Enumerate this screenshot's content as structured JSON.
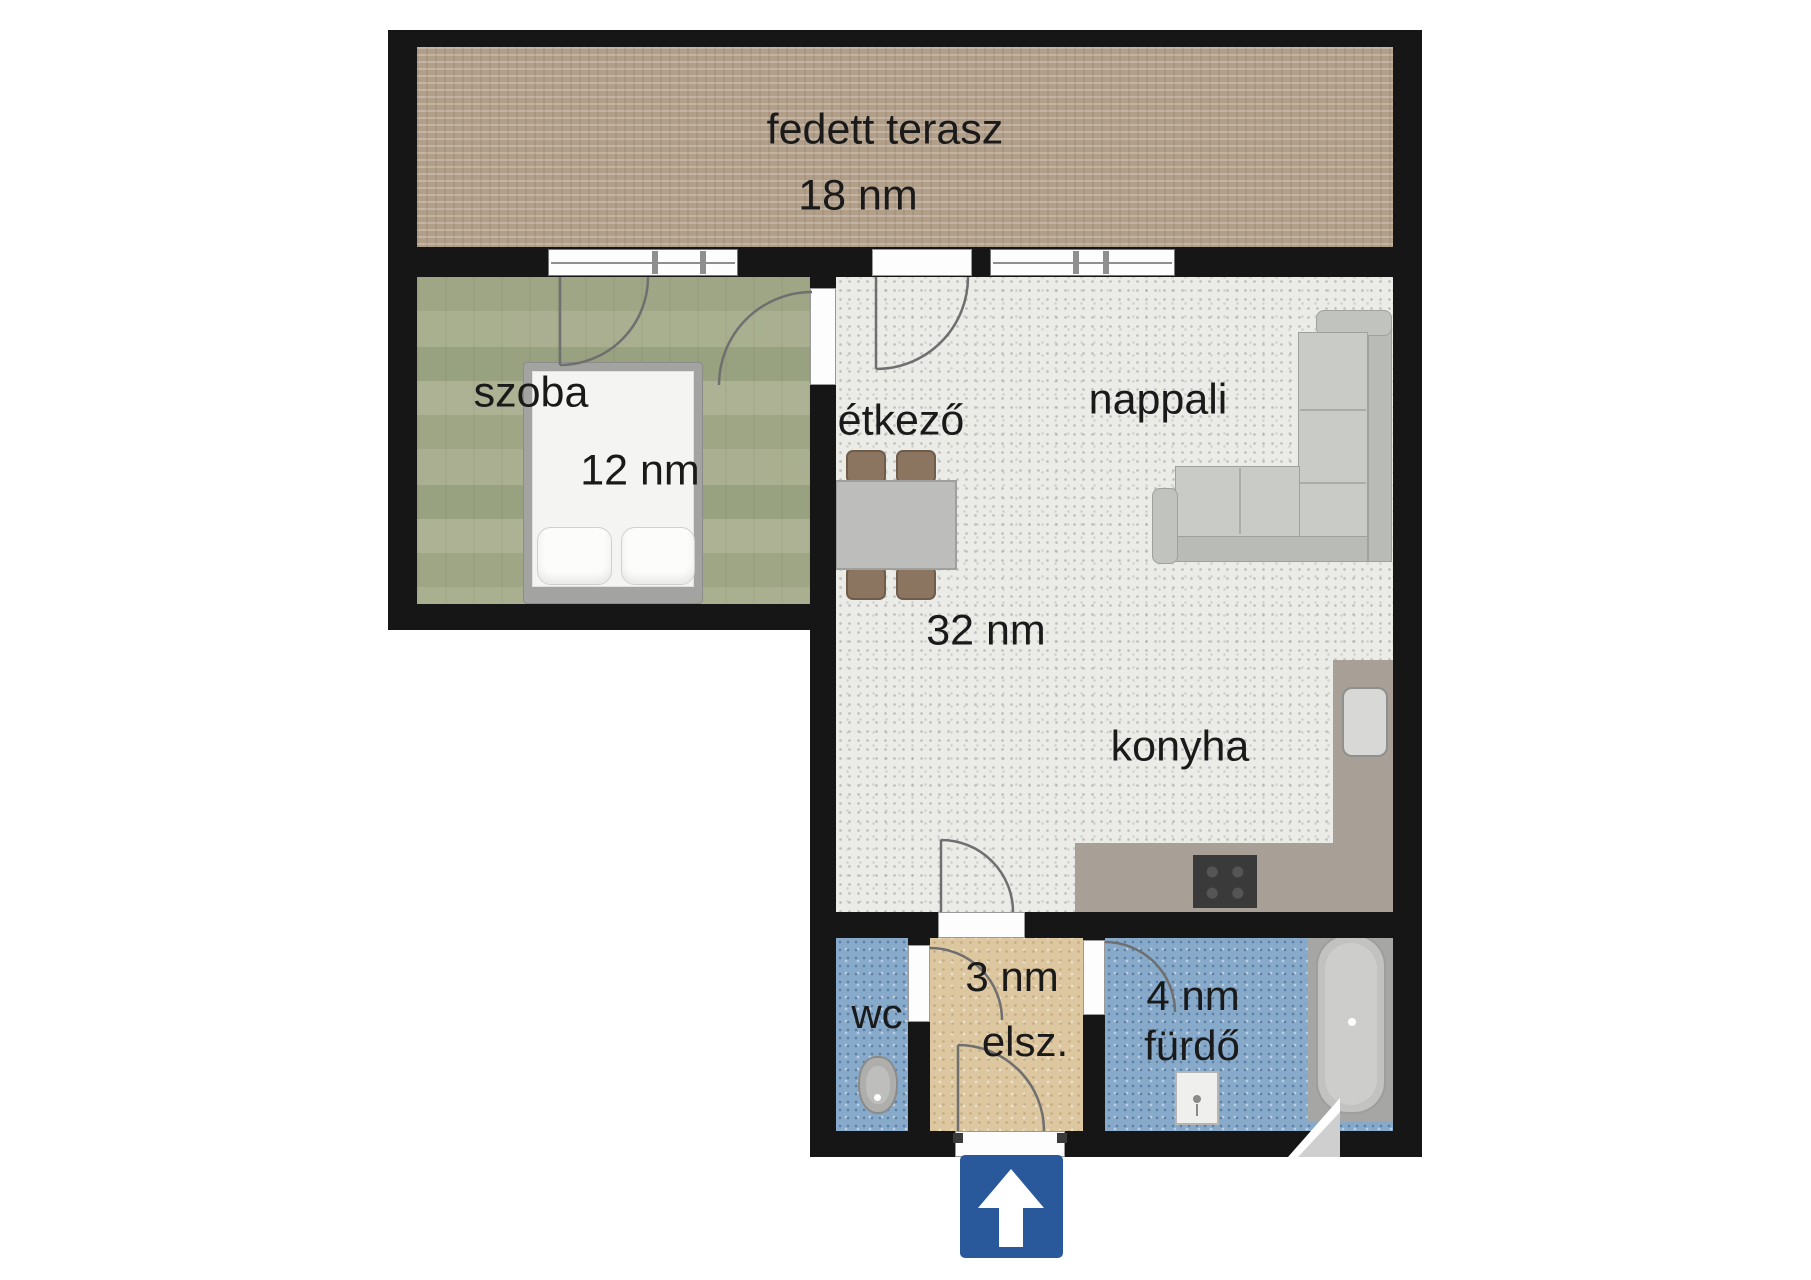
{
  "plan_title": "apartment floor plan",
  "rooms": {
    "terrace": {
      "name": "fedett terasz",
      "area": "18 nm"
    },
    "bedroom": {
      "name": "szoba",
      "area": "12 nm"
    },
    "dining": {
      "name": "étkező"
    },
    "living": {
      "name": "nappali",
      "area": "32 nm"
    },
    "kitchen": {
      "name": "konyha"
    },
    "wc": {
      "name": "wc"
    },
    "hall": {
      "name": "elsz.",
      "area": "3 nm"
    },
    "bathroom": {
      "name": "fürdő",
      "area": "4 nm"
    }
  },
  "colors": {
    "wall": "#161616",
    "terrace_floor": "#b29f8a",
    "bedroom_floor": "#ccd0bc",
    "living_floor": "#ebebe8",
    "hall_floor": "#dcc7a1",
    "wet_room_floor": "#87aacb",
    "kitchen_counter": "#a8a096",
    "cooktop": "#3a3a3a",
    "entrance_arrow_blue": "#29599b"
  },
  "icons": {
    "entrance_arrow": "arrow-up"
  }
}
